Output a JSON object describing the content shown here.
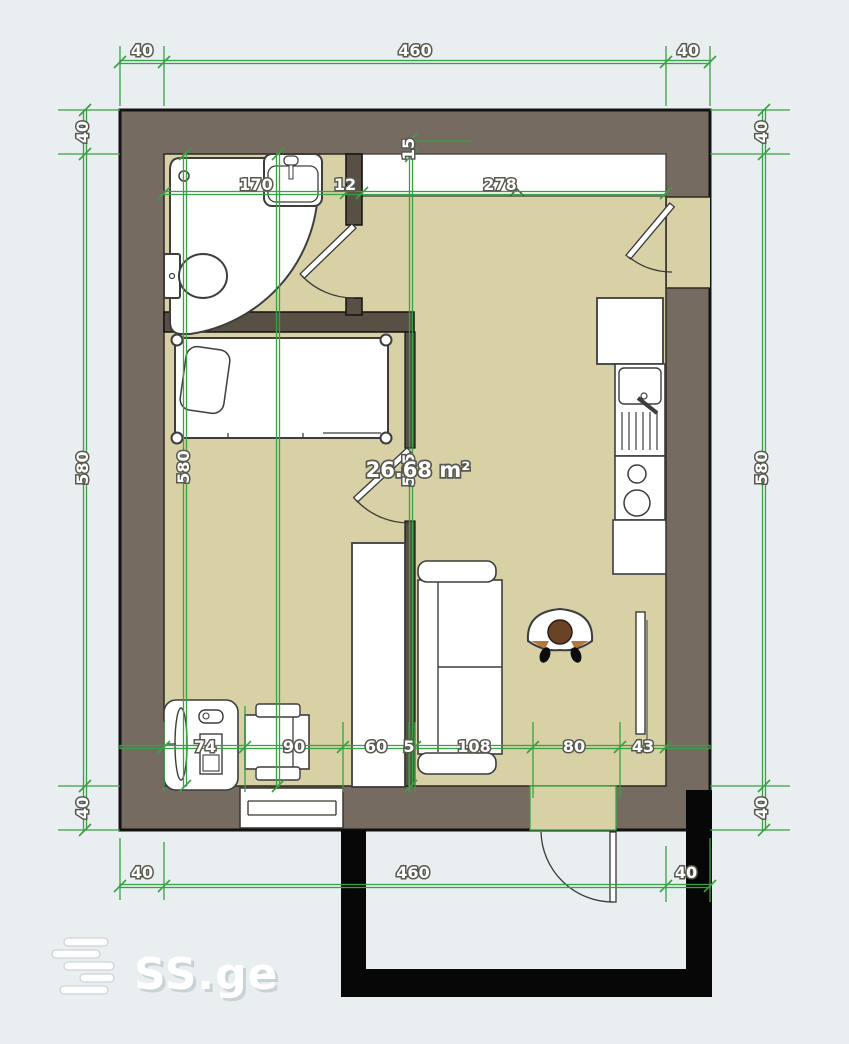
{
  "watermark": {
    "brand": "SS.ge"
  },
  "area": {
    "label": "26.68 m²"
  },
  "dims": {
    "top": [
      "40",
      "460",
      "40"
    ],
    "bottom": [
      "40",
      "460",
      "40"
    ],
    "left": [
      "40",
      "580",
      "40"
    ],
    "right": [
      "40",
      "580",
      "40"
    ],
    "inner_top": [
      "170",
      "12",
      "278"
    ],
    "inner_top_v": "15",
    "inner_left_v": "580",
    "inner_mid_v": "565",
    "inner_bottom": [
      "74",
      "90",
      "60",
      "5",
      "108",
      "80",
      "43"
    ]
  },
  "colors": {
    "background": "#e9eef1",
    "wall": "#756b60",
    "inner_wall": "#584f45",
    "floor": "#d8d1a6",
    "dimension_green": "#3aa044",
    "balcony_black": "#070707"
  },
  "fixtures": [
    "corner-bathtub",
    "bathroom-sink",
    "toilet",
    "bed",
    "wardrobe",
    "sofa",
    "armchair-with-person",
    "dining-table-with-chairs",
    "vanity-dresser",
    "refrigerator",
    "kitchen-sink",
    "dish-drainer",
    "stove",
    "kitchen-cabinet",
    "tv",
    "entrance-door",
    "bathroom-door",
    "bedroom-door",
    "balcony-door",
    "top-window",
    "bottom-window",
    "balcony"
  ]
}
